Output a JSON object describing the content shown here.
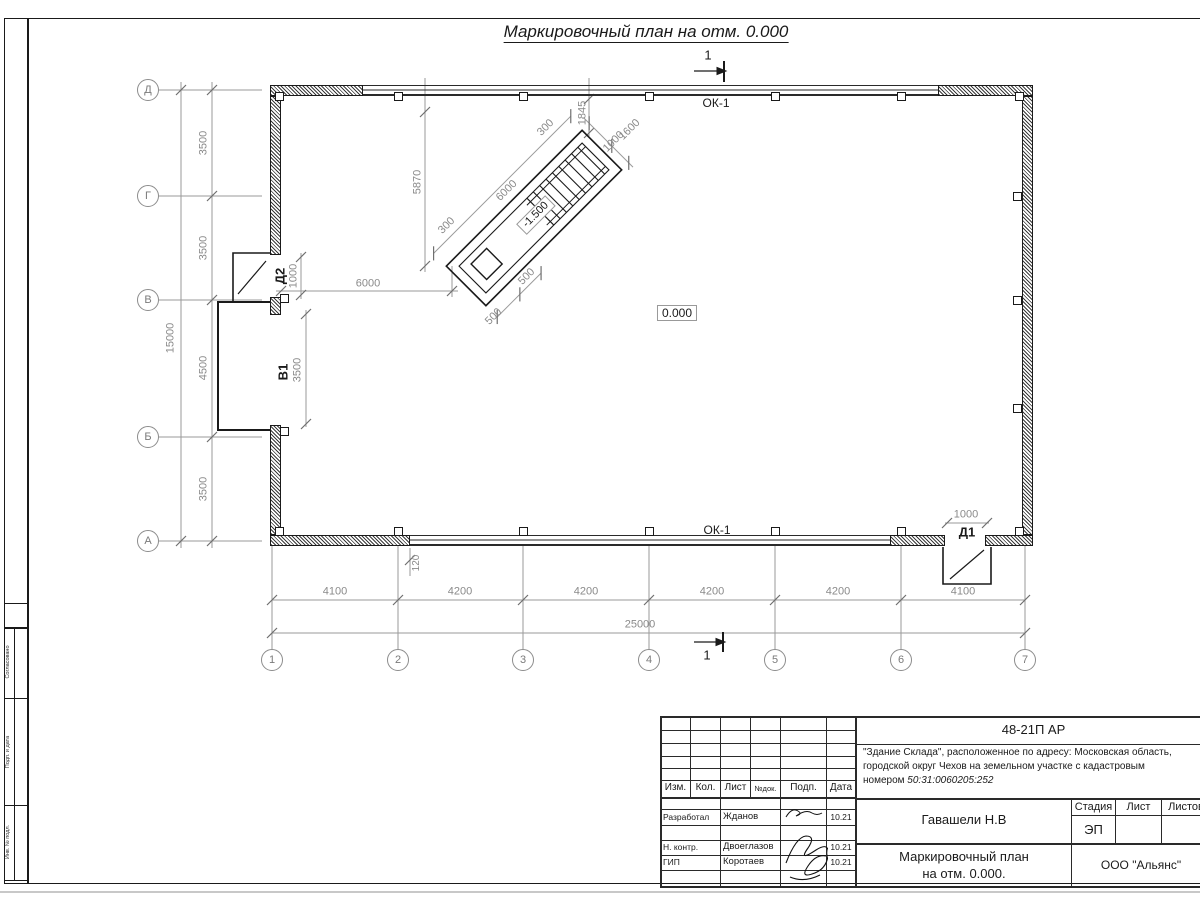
{
  "page": {
    "title": "Маркировочный план на отм. 0.000"
  },
  "plan": {
    "section_mark_top": "1",
    "section_mark_bottom": "1",
    "window_top": "ОК-1",
    "window_bottom": "ОК-1",
    "door_right": "Д1",
    "door_left": "Д2",
    "gate_left": "В1",
    "elevation_zero": "0.000",
    "elevation_pit": "-1.500",
    "axes_rows": [
      "Д",
      "Г",
      "В",
      "Б",
      "А"
    ],
    "axes_cols": [
      "1",
      "2",
      "3",
      "4",
      "5",
      "6",
      "7"
    ],
    "dims": {
      "row_chain": [
        "3500",
        "3500",
        "4500",
        "3500"
      ],
      "row_total": "15000",
      "col_chain": [
        "4100",
        "4200",
        "4200",
        "4200",
        "4200",
        "4100"
      ],
      "col_total": "25000",
      "door_left_width": "1000",
      "gate_width": "3500",
      "gate_to_ramp": "6000",
      "door_right_width": "1000",
      "wall_offset": "120",
      "ramp_height": "5870",
      "ramp_length": "6000",
      "ramp_300_top": "300",
      "ramp_1845": "1845",
      "ramp_1600": "1600",
      "ramp_1000": "1000",
      "ramp_300_left": "300",
      "ramp_500_a": "500",
      "ramp_500_b": "500"
    }
  },
  "frame_strip": {
    "agreed": "Согласовано",
    "label_mid": "Подп. и дата",
    "label_bottom": "Инв. № подл."
  },
  "title_block": {
    "doc_number": "48-21П АР",
    "address_line1": "\"Здание Склада\", расположенное по адресу: Московская область,",
    "address_line2": "городской округ Чехов на земельном участке с кадастровым",
    "address_line3_prefix": "номером ",
    "address_line3_cadastral": "50:31:0060205:252",
    "header": {
      "izm": "Изм.",
      "kol": "Кол.",
      "list": "Лист",
      "ndok": "№док.",
      "podp": "Подп.",
      "data": "Дата"
    },
    "rows": [
      {
        "role": "Разработал",
        "name": "Жданов",
        "date": "10.21"
      },
      {
        "role": "Н. контр.",
        "name": "Двоеглазов",
        "date": "10.21"
      },
      {
        "role": "ГИП",
        "name": "Коротаев",
        "date": "10.21"
      }
    ],
    "chief": "Гавашели Н.В",
    "stage_label": "Стадия",
    "sheet_label": "Лист",
    "sheets_label": "Листов",
    "stage_value": "ЭП",
    "drawing_title_line1": "Маркировочный план",
    "drawing_title_line2": "на отм. 0.000.",
    "company": "ООО \"Альянс\""
  }
}
